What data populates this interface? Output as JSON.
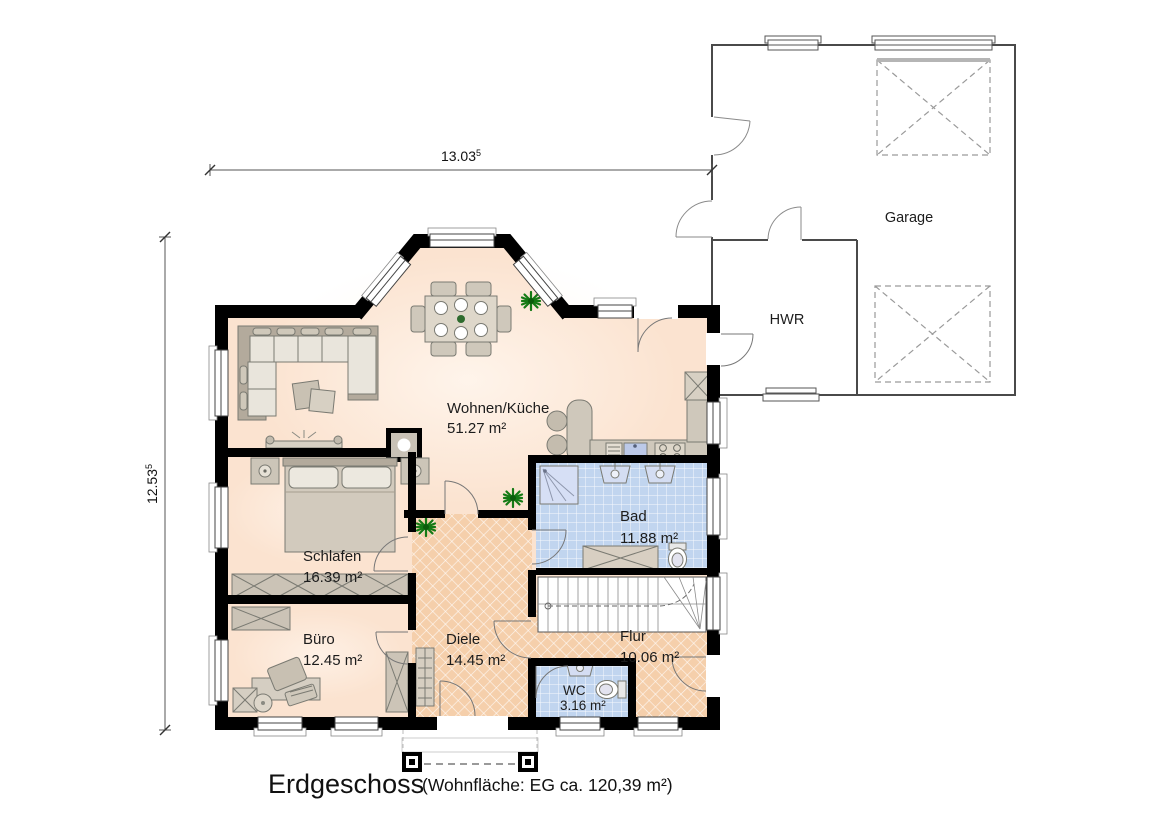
{
  "plan": {
    "title": "Erdgeschoss",
    "area_note": "(Wohnfläche: EG  ca. 120,39 m²)"
  },
  "dimensions": {
    "width": {
      "value": "13.03",
      "sup": "5"
    },
    "height": {
      "value": "12.53",
      "sup": "5"
    }
  },
  "rooms": {
    "wohnen": {
      "name": "Wohnen/Küche",
      "area": "51.27 m²"
    },
    "schlafen": {
      "name": "Schlafen",
      "area": "16.39 m²"
    },
    "buero": {
      "name": "Büro",
      "area": "12.45 m²"
    },
    "diele": {
      "name": "Diele",
      "area": "14.45 m²"
    },
    "bad": {
      "name": "Bad",
      "area": "11.88 m²"
    },
    "flur": {
      "name": "Flur",
      "area": "10.06 m²"
    },
    "wc": {
      "name": "WC",
      "area": "3.16 m²"
    },
    "garage": {
      "name": "Garage"
    },
    "hwr": {
      "name": "HWR"
    }
  },
  "colors": {
    "wall": "#000000",
    "room_fill": "#fbe3d0",
    "hall_tile": "#f5cfab",
    "bath_tile": "#c1d5ef",
    "furniture": "#d7d0c3",
    "plant_green": "#1b7a1b"
  }
}
